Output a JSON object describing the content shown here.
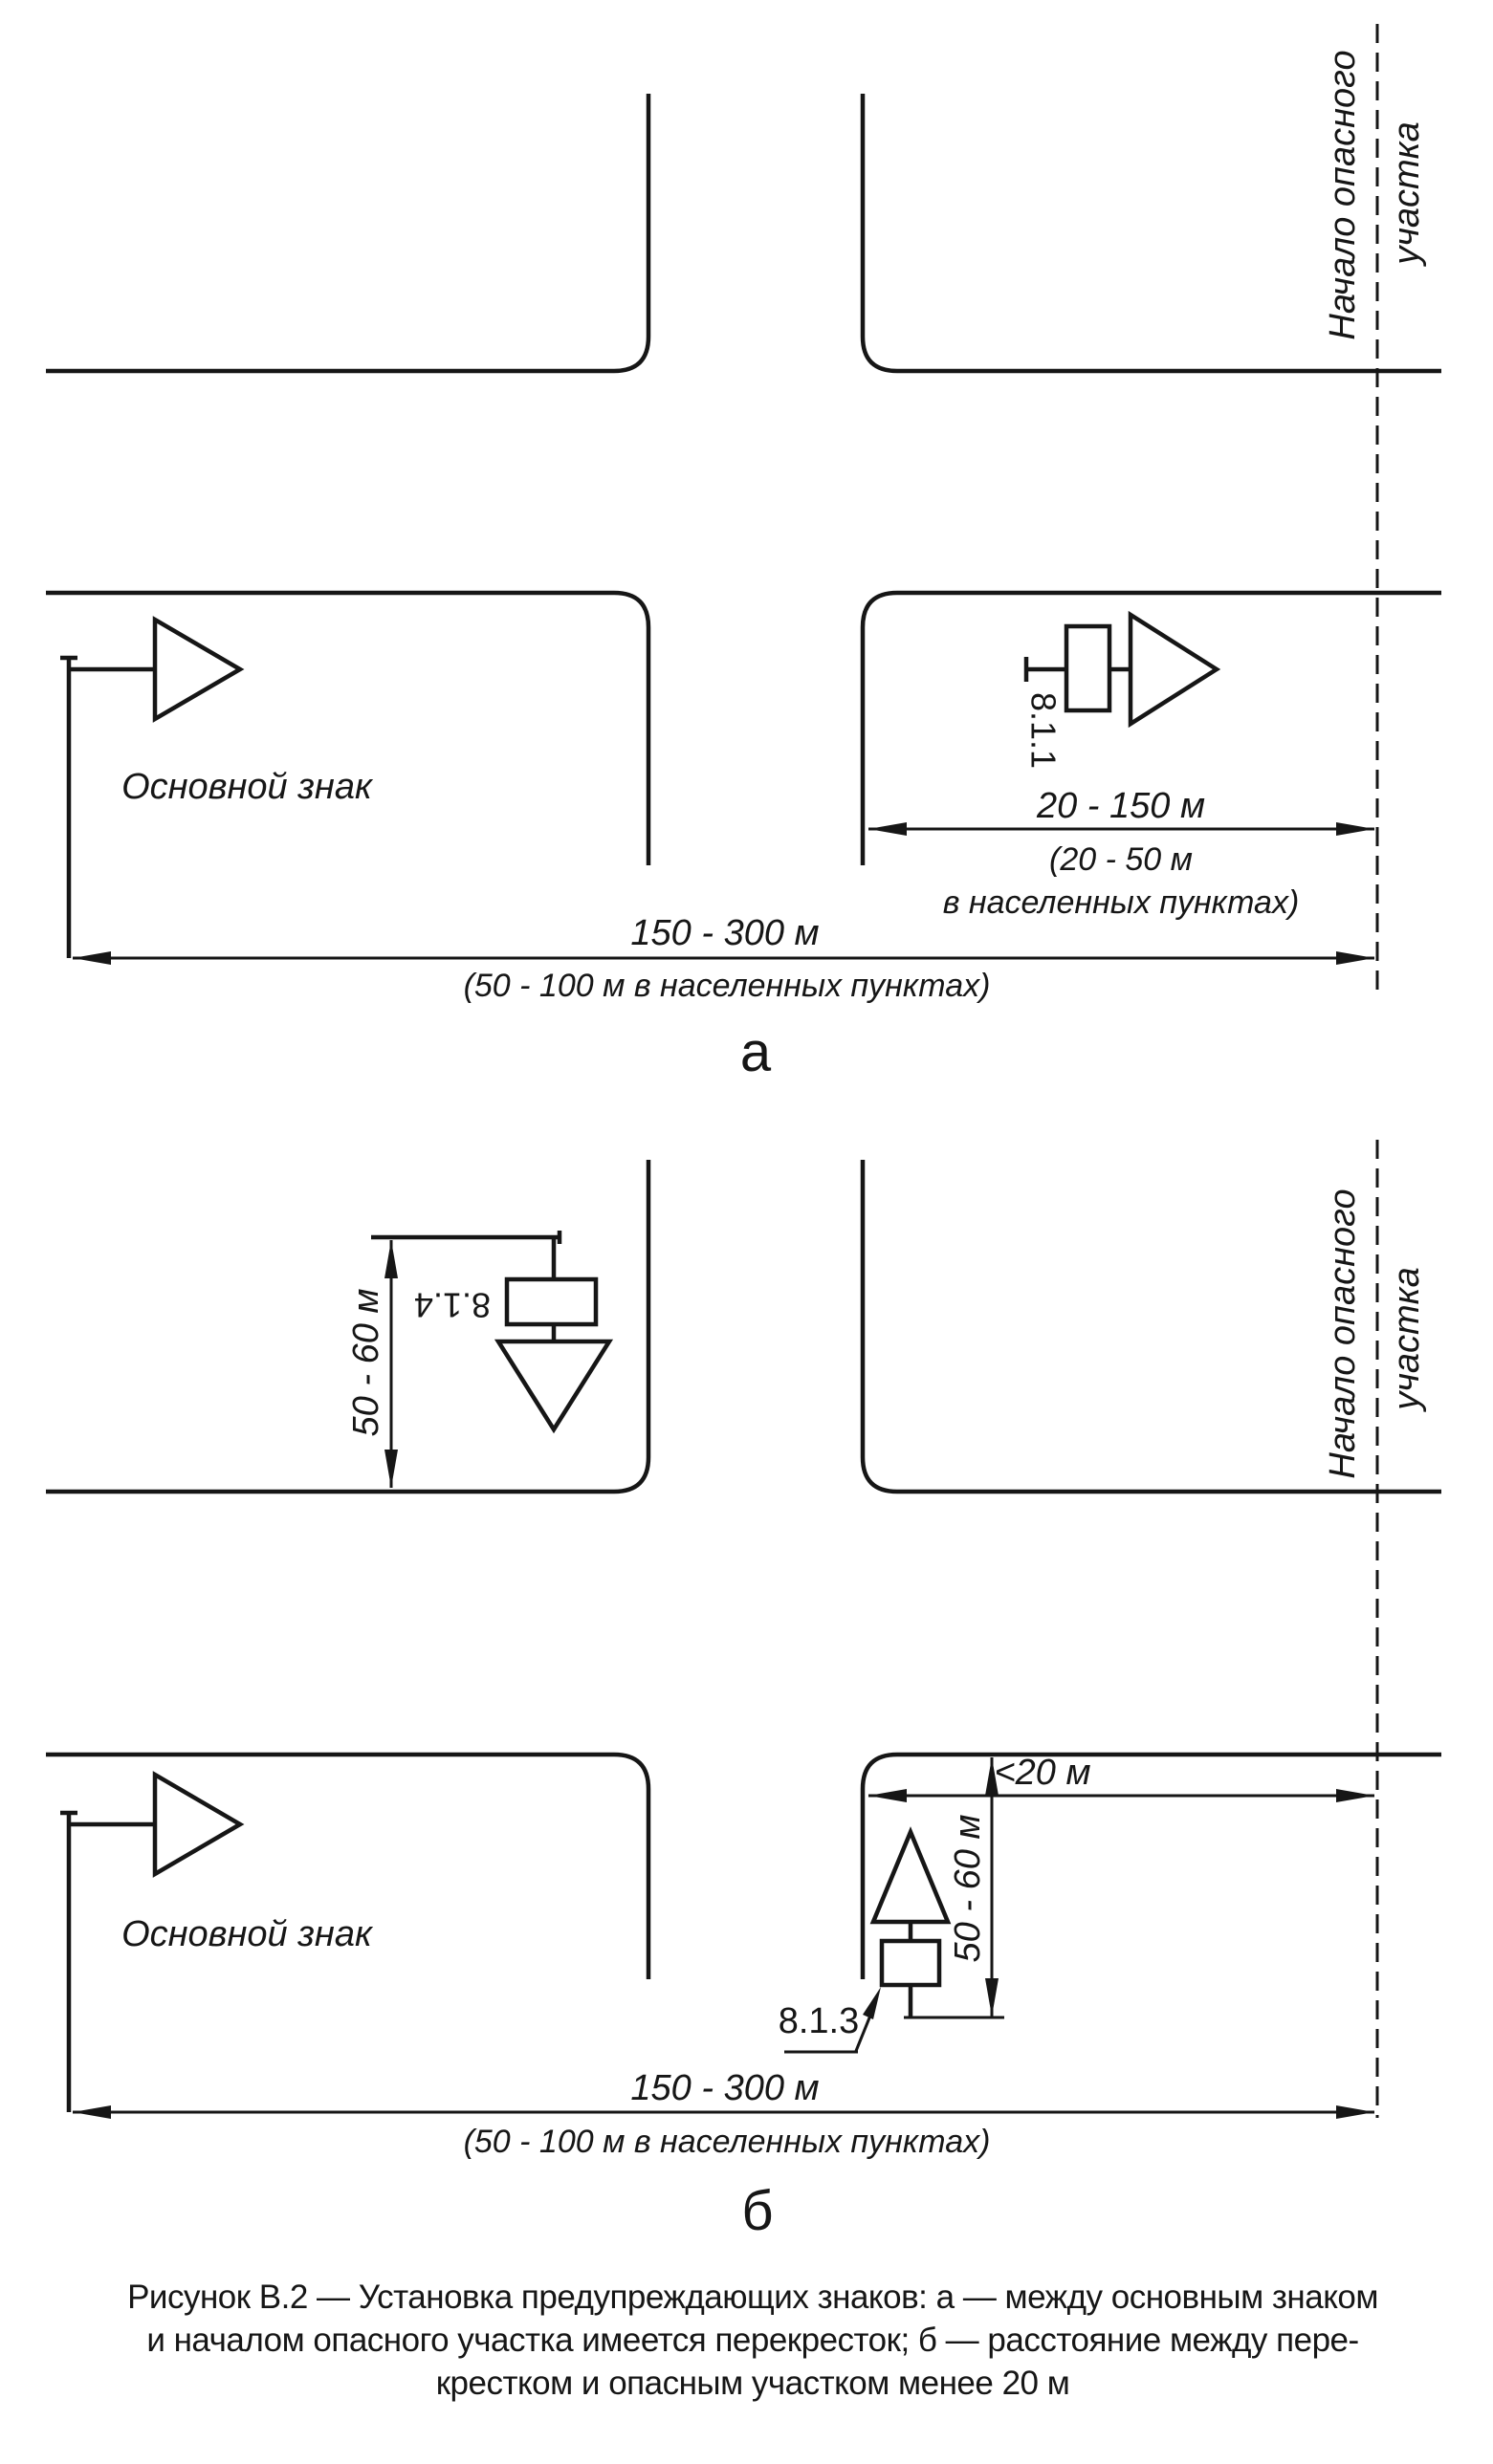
{
  "colors": {
    "ink": "#161616",
    "paper": "#ffffff"
  },
  "figure": {
    "caption": {
      "line1": "Рисунок В.2 — Установка предупреждающих знаков: а — между основным знаком",
      "line2": "и началом опасного участка имеется перекресток; б — расстояние между пере-",
      "line3": "крестком и опасным участком менее 20 м"
    },
    "diagram_a": {
      "label": "а",
      "hazard_label_line1": "Начало опасного",
      "hazard_label_line2": "участка",
      "main_sign_label": "Основной знак",
      "plate_number": "8.1.1",
      "dim_offset": {
        "value": "20 - 150 м",
        "note_line1": "(20 - 50 м",
        "note_line2": "в населенных пунктах)"
      },
      "dim_total": {
        "value": "150 - 300 м",
        "note": "(50 - 100 м в населенных пунктах)"
      }
    },
    "diagram_b": {
      "label": "б",
      "hazard_label_line1": "Начало опасного",
      "hazard_label_line2": "участка",
      "main_sign_label": "Основной знак",
      "plate_number_top": "8.1.4",
      "plate_number_bottom": "8.1.3",
      "dim_height_top": "50 - 60 м",
      "dim_height_right": "50 - 60 м",
      "dim_gap": "<20 м",
      "dim_total": {
        "value": "150 - 300 м",
        "note": "(50 - 100 м в населенных пунктах)"
      }
    }
  }
}
